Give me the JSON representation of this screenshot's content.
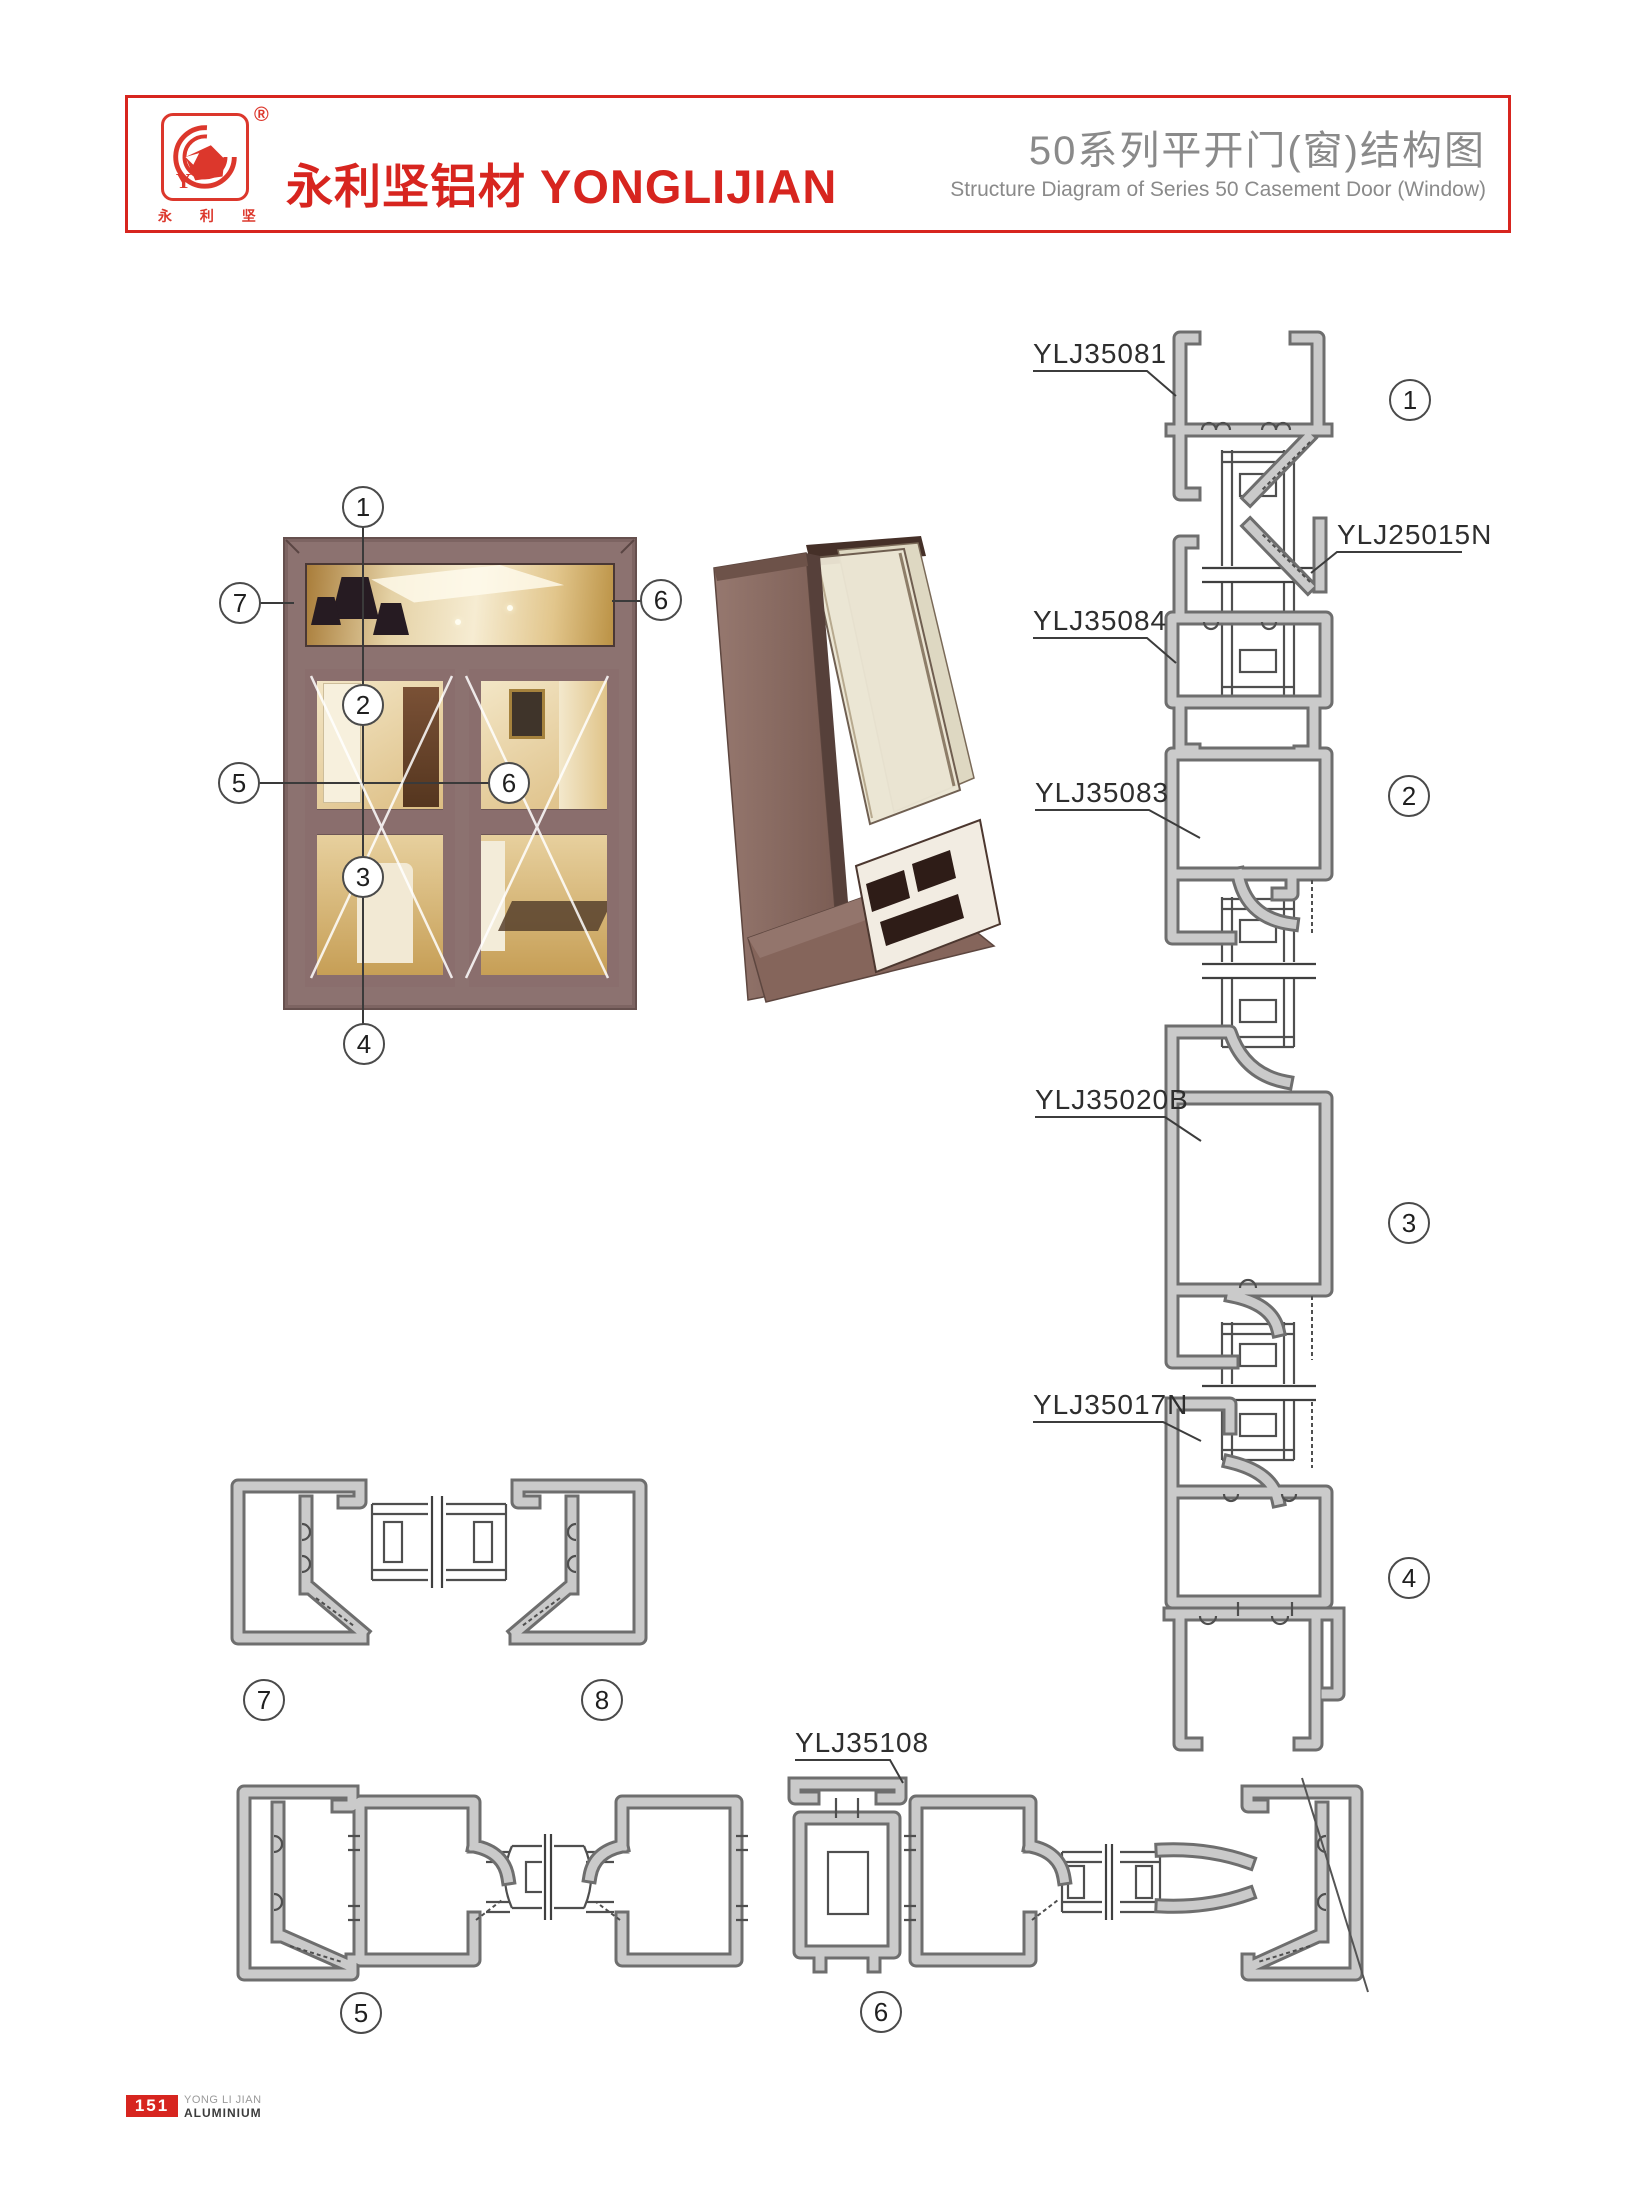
{
  "header": {
    "brand_cn": "永利坚铝材",
    "brand_en": "YONGLIJIAN",
    "brand_full": "永利坚铝材 YONGLIJIAN",
    "registered_mark": "®",
    "logo_chars": "永 利 坚",
    "logo_monogram": "Y",
    "title_cn": "50系列平开门(窗)结构图",
    "title_en": "Structure Diagram of Series 50 Casement Door (Window)"
  },
  "diagram": {
    "parts": [
      "YLJ35081",
      "YLJ25015N",
      "YLJ35084",
      "YLJ35083",
      "YLJ35020B",
      "YLJ35017N",
      "YLJ35108"
    ],
    "callouts": [
      "1",
      "2",
      "3",
      "4",
      "5",
      "6",
      "7",
      "8"
    ]
  },
  "footer": {
    "page_number": "151",
    "brand_line1": "YONG LI JIAN",
    "brand_line2": "ALUMINIUM"
  },
  "colors": {
    "accent_red": "#d7251f",
    "logo_red": "#dc372c",
    "title_gray": "#8a8a8a",
    "metal_fill": "#cacaca",
    "metal_outline": "#6e6e6e",
    "frame_brown": "#8c7270"
  }
}
